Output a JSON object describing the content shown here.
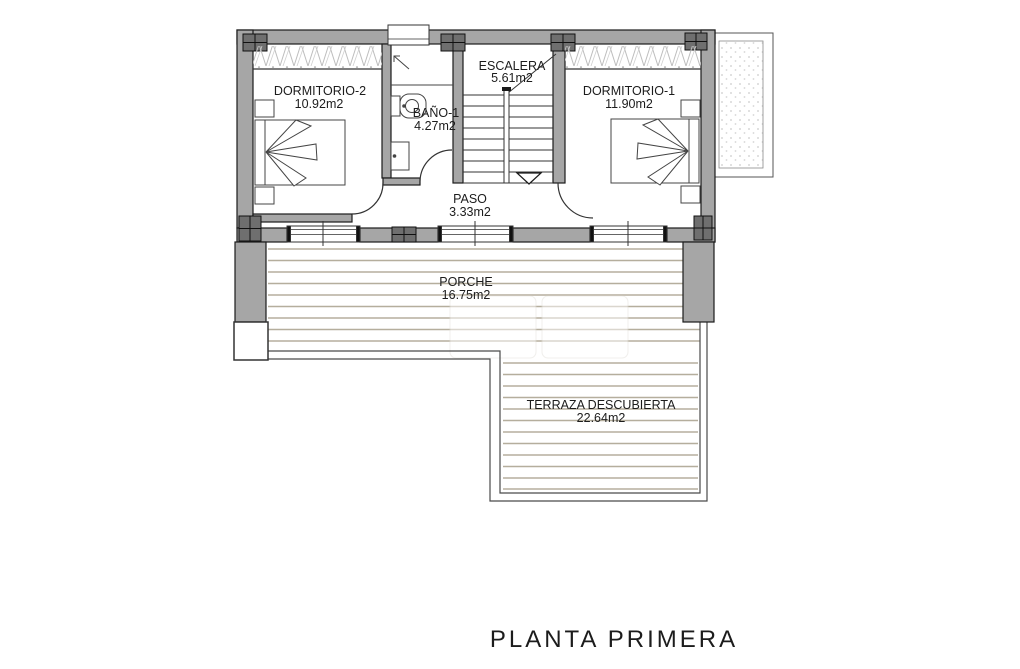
{
  "title": "PLANTA PRIMERA",
  "rooms": {
    "dormitorio2": {
      "label": "DORMITORIO-2",
      "area": "10.92m2"
    },
    "bano1": {
      "label": "BAÑO-1",
      "area": "4.27m2"
    },
    "escalera": {
      "label": "ESCALERA",
      "area": "5.61m2"
    },
    "dormitorio1": {
      "label": "DORMITORIO-1",
      "area": "11.90m2"
    },
    "paso": {
      "label": "PASO",
      "area": "3.33m2"
    },
    "porche": {
      "label": "PORCHE",
      "area": "16.75m2"
    },
    "terraza": {
      "label": "TERRAZA DESCUBIERTA",
      "area": "22.64m2"
    }
  },
  "colors": {
    "wall": "#a6a6a6",
    "column": "#6f6f6f",
    "outline": "#1c1c1c",
    "deck_line": "#b5ae9d",
    "hatch": "#bdbdbd",
    "stipple": "#cccccc"
  }
}
